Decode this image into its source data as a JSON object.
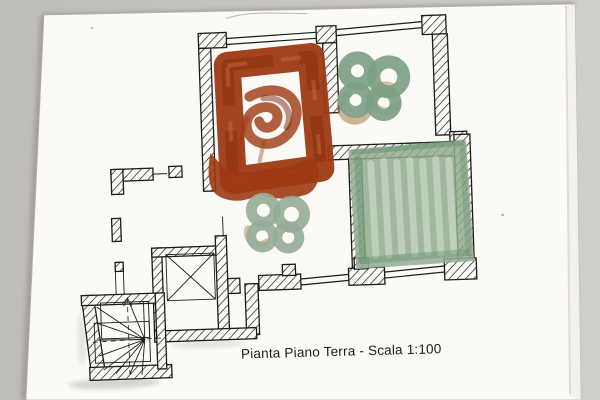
{
  "photo": {
    "description_caption": "Pianta Piano Terra - Scala 1:100"
  },
  "colors": {
    "background": "#c8c6c2",
    "paper": "#fbfaf6",
    "ink": "#1c1c1c",
    "red_paint": "#9e3a14",
    "red_dark": "#7c2708",
    "red_light": "#c06a3c",
    "green_paint": "#7da186",
    "green_light": "#93ac96",
    "green_wash": "#90aa8e",
    "green_dark": "#67926f",
    "brown_accent": "#aa7a42",
    "tan_accent": "#b3a078",
    "pencil": "#8c8c88",
    "shadow": "#8e8a84"
  },
  "plan": {
    "caption": "Pianta Piano Terra - Scala 1:100",
    "scale": "1:100",
    "elements": [
      {
        "name": "red-painted-room",
        "paint": "rust-red painted frame with central swirl and drips"
      },
      {
        "name": "green-flower-top-right",
        "paint": "sage-green clover-shaped blob with brown accents"
      },
      {
        "name": "green-flower-center",
        "paint": "pale sage-green clover-shaped blob with tan accent"
      },
      {
        "name": "green-washed-room",
        "paint": "sage-green brushed wash fill with streaks"
      },
      {
        "name": "elevator-shaft",
        "symbol": "square with diagonal cross"
      },
      {
        "name": "winder-staircase",
        "symbol": "fanned treads with dashed walking line"
      }
    ]
  }
}
